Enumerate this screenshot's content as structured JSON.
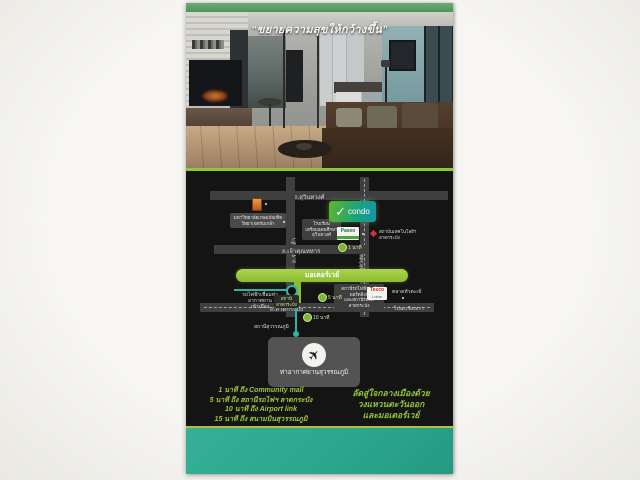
{
  "scan": {
    "background": "#f4f3ef"
  },
  "brochure": {
    "quote": "“ขยายความสุขให้กว้างขึ้น”",
    "accent_green": "#8cc63e",
    "top_band_color": "#4c9259",
    "bottom_band_color": "#2aa78d"
  },
  "map": {
    "background": "#141414",
    "roads": {
      "suwinthawong": "ถ.สุวินทวงศ์",
      "chaokhun_thahan": "ถ.เจ้าคุณทหาร",
      "motorway": "มอเตอร์เวย์",
      "lat_krabang": "ถ.ลาดกระบัง",
      "rom_klao": "ถ.ร่มเกล้า",
      "luang_phaeng": "ถ.หลวงแพ่ง",
      "to_chachoengsao": "ไปฉะเชิงเทรา"
    },
    "project_logo": {
      "check": "✓",
      "name": "condo"
    },
    "landmarks": {
      "kasem_bundit": [
        "มหาวิทยาลัยเกษมบัณฑิต",
        "วิทยาเขตร่มเกล้า"
      ],
      "school": [
        "โรงเรียน",
        "เตรียมอุดมศึกษา",
        "สุวินทวงศ์"
      ],
      "kmitl": [
        "สถาบันเทคโนโลยีฯ",
        "ลาดกระบัง"
      ],
      "paseo": "Paseo",
      "tesco_line1": "Tesco",
      "tesco_line2": "Lotus",
      "hua_takhe": "ตลาดหัวตะเข้"
    },
    "rail": {
      "city_link": [
        "รถไฟฟ้าเชื่อมท่าอากาศยาน",
        "เข้าเมือง"
      ],
      "station": [
        "สถานี",
        "ลาดกระบัง"
      ],
      "airport_link_station": [
        "สถานีรถไฟฟ้าแอร์พอร์ตลิงก์",
        "และสถานีรถไฟ",
        "ลาดกระบัง"
      ],
      "suvarnabhumi_station": "สถานีสุวรรณภูมิ"
    },
    "markers": {
      "m1": "1 นาที",
      "m5": "5 นาที",
      "m10": "10 นาที"
    },
    "airport": {
      "icon": "✈",
      "label": "ท่าอากาศยานสุวรรณภูมิ"
    }
  },
  "footer": {
    "left": [
      "1 นาที ถึง Community mall",
      "5 นาที ถึง สถานีรถไฟฯ ลาดกระบัง",
      "10 นาที ถึง Airport link",
      "15 นาที ถึง สนามบินสุวรรณภูมิ"
    ],
    "right": [
      "ลัดสู่ใจกลางเมืองด้วย",
      "วงแหวนตะวันออก",
      "และมอเตอร์เวย์"
    ]
  }
}
